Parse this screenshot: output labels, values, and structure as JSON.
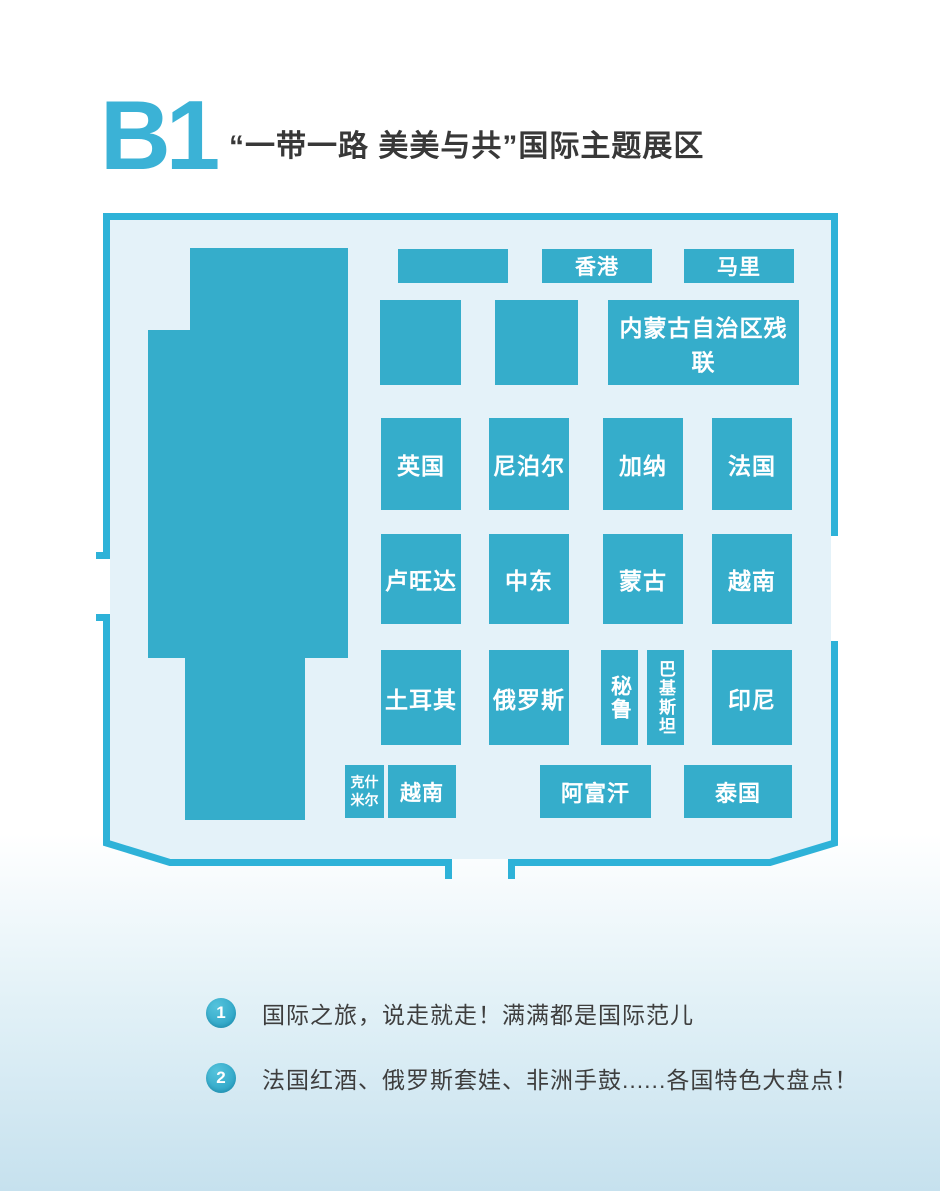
{
  "header": {
    "hall_code": "B1",
    "hall_title": "“一带一路 美美与共”国际主题展区"
  },
  "colors": {
    "booth_teal": "#35adcb",
    "wall_teal": "#2eb2d8",
    "map_interior": "#e4f2f9",
    "title_teal": "#3bb2d6",
    "text_dark": "#3e3e3e",
    "page_bottom": "#c6e1ee"
  },
  "map": {
    "stage_block": "large-unlabeled-hall-block",
    "booths": [
      {
        "label": "",
        "x": 398,
        "y": 249,
        "w": 110,
        "h": 34
      },
      {
        "label": "香港",
        "x": 542,
        "y": 249,
        "w": 110,
        "h": 34,
        "fs": 21
      },
      {
        "label": "马里",
        "x": 684,
        "y": 249,
        "w": 110,
        "h": 34,
        "fs": 21
      },
      {
        "label": "",
        "x": 380,
        "y": 300,
        "w": 81,
        "h": 85
      },
      {
        "label": "",
        "x": 495,
        "y": 300,
        "w": 83,
        "h": 85
      },
      {
        "label": "内蒙古自治区残联",
        "x": 608,
        "y": 300,
        "w": 191,
        "h": 85,
        "fs": 23
      },
      {
        "label": "英国",
        "x": 381,
        "y": 418,
        "w": 80,
        "h": 92,
        "fs": 23
      },
      {
        "label": "尼泊尔",
        "x": 489,
        "y": 418,
        "w": 80,
        "h": 92,
        "fs": 23
      },
      {
        "label": "加纳",
        "x": 603,
        "y": 418,
        "w": 80,
        "h": 92,
        "fs": 23
      },
      {
        "label": "法国",
        "x": 712,
        "y": 418,
        "w": 80,
        "h": 92,
        "fs": 23
      },
      {
        "label": "卢旺达",
        "x": 381,
        "y": 534,
        "w": 80,
        "h": 90,
        "fs": 23
      },
      {
        "label": "中东",
        "x": 489,
        "y": 534,
        "w": 80,
        "h": 90,
        "fs": 23
      },
      {
        "label": "蒙古",
        "x": 603,
        "y": 534,
        "w": 80,
        "h": 90,
        "fs": 23
      },
      {
        "label": "越南",
        "x": 712,
        "y": 534,
        "w": 80,
        "h": 90,
        "fs": 23
      },
      {
        "label": "土耳其",
        "x": 381,
        "y": 650,
        "w": 80,
        "h": 95,
        "fs": 23
      },
      {
        "label": "俄罗斯",
        "x": 489,
        "y": 650,
        "w": 80,
        "h": 95,
        "fs": 23
      },
      {
        "label": "秘鲁",
        "x": 601,
        "y": 650,
        "w": 37,
        "h": 95,
        "fs": 21,
        "vertical": true
      },
      {
        "label": "巴基斯坦",
        "x": 647,
        "y": 650,
        "w": 37,
        "h": 95,
        "fs": 17,
        "vertical": true
      },
      {
        "label": "印尼",
        "x": 712,
        "y": 650,
        "w": 80,
        "h": 95,
        "fs": 23
      },
      {
        "label": "克什米尔",
        "x": 345,
        "y": 765,
        "w": 39,
        "h": 53,
        "fs": 14,
        "wrap": true
      },
      {
        "label": "越南",
        "x": 388,
        "y": 765,
        "w": 68,
        "h": 53,
        "fs": 21
      },
      {
        "label": "阿富汗",
        "x": 540,
        "y": 765,
        "w": 111,
        "h": 53,
        "fs": 22
      },
      {
        "label": "泰国",
        "x": 684,
        "y": 765,
        "w": 108,
        "h": 53,
        "fs": 22
      }
    ]
  },
  "notes": [
    {
      "num": "1",
      "text": "国际之旅，说走就走！满满都是国际范儿"
    },
    {
      "num": "2",
      "text": "法国红酒、俄罗斯套娃、非洲手鼓......各国特色大盘点！"
    }
  ]
}
